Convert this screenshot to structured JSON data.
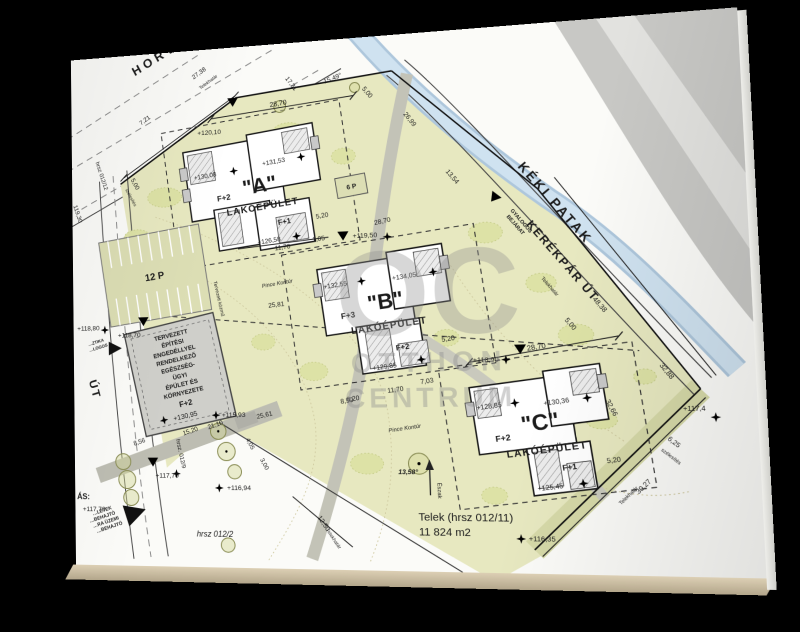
{
  "watermark": {
    "oc": "OC",
    "otthon": "OTTHON",
    "centrum": "CENTRUM"
  },
  "streets": {
    "horvath": "HORVÁ",
    "ut": "ÚT",
    "keki": "KÉKI PATAK",
    "kerekpar": "KERÉKPÁR ÚT",
    "gyalogos1": "GYALOGOS",
    "gyalogos2": "BEJÁRAT"
  },
  "buildings": {
    "a": {
      "q": "\"A\"",
      "floors": "F+2",
      "label": "LAKÓÉPÜLET",
      "e1": "+130,08",
      "e2": "+131,53",
      "sub": "F+1",
      "sube": "+126,58"
    },
    "b": {
      "q": "\"B\"",
      "floors": "F+3",
      "label": "LAKÓÉPÜLET",
      "e1": "+132,55",
      "e2": "+134,05",
      "sub": "F+2",
      "sube": "+129,85"
    },
    "c": {
      "q": "\"C\"",
      "floors": "F+2",
      "label": "LAKÓÉPÜLET",
      "e1": "+128,85",
      "e2": "+130,36",
      "sub": "F+1",
      "sube": "+125,45"
    },
    "health": {
      "lines": [
        "TERVEZETT",
        "ÉPÍTÉSI",
        "ENGEDÉLLYEL",
        "RENDELKEZŐ",
        "EGÉSZSÉG-",
        "ÜGYI",
        "ÉPÜLET ÉS",
        "KÖRNYEZETE"
      ],
      "floors": "F+2",
      "elev": "+130,95"
    }
  },
  "parking": {
    "p12": "12 P",
    "p6": "6 P"
  },
  "site": {
    "telek1": "Telek (hrsz 012/11)",
    "telek2": "11 824 m2",
    "hrsz012_2": "hrsz 012/2",
    "hrsz012_12": "hrsz 012/12",
    "hrsz012_9": "hrsz. 012/9",
    "telekhatar": "Telekhatár",
    "eszak": "Észak",
    "north_angle": "13,58°",
    "pince": "Pince Kontúr",
    "tervezett": "Tervezett közmű",
    "szelesites": "szélesítés",
    "as_label": "ÁS:",
    "ztika": "…ZTIKA",
    "logos": "…LOGOS",
    "behajto": [
      "…LETEK",
      "…BEHAJTÓ",
      "…RA ÜZEMI",
      "…BEHAJTÓ"
    ]
  },
  "dims": {
    "d27_38": "27,38",
    "d7_21": "7,21",
    "d17_31": "17,31",
    "d15_49": "15,49°",
    "d28_70": "28,70",
    "d5_00": "5,00",
    "d26_99": "26,99",
    "d13_54": "13,54",
    "d48_38": "48,38",
    "d32_88": "32,88",
    "d32_66": "32,66",
    "d6_25": "6,25",
    "d30_27": "30,27",
    "d12_50": "12,50",
    "d11_70": "11,70",
    "d1_05": "1,05",
    "d5_20": "5,20",
    "d7_03": "7,03",
    "d8_20": "8,20",
    "d25_81": "25,81",
    "d25_61": "25,61",
    "d8_50": "8,50",
    "d8_56": "8,56",
    "d15_20": "15,20",
    "d21_10": "21,10",
    "d4_05": "4,05",
    "d3_00": "3,00"
  },
  "elev": {
    "e119_30": "119,30",
    "e120_10": "+120,10",
    "e119_50": "+119,50",
    "e118_90": "+118,90",
    "e118_80": "+118,80",
    "e118_70": "+118,70",
    "e117_70": "+117,70",
    "e116_94": "+116,94",
    "e116_35": "+116,35",
    "e115_93": "+115,93",
    "e117_4": "+117,4"
  }
}
